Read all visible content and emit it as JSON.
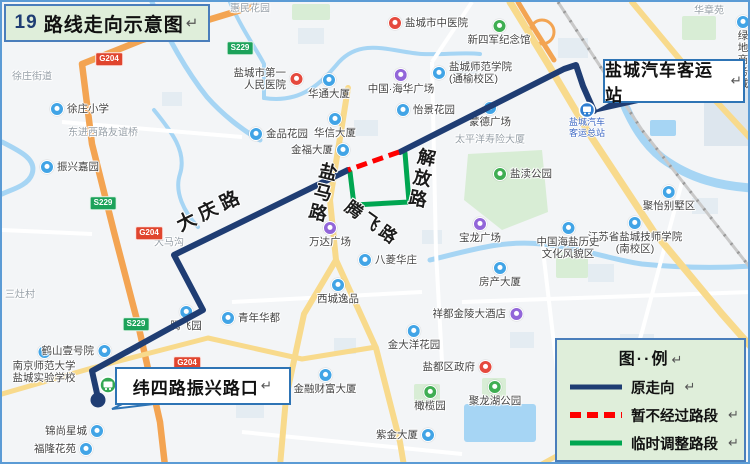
{
  "title": {
    "prefix": "19",
    "text": "路线走向示意图"
  },
  "marks": {
    "return": "↵"
  },
  "callouts": {
    "terminal": "盐城汽车客运站",
    "weisi": "纬四路振兴路口"
  },
  "legend": {
    "title": "图··例",
    "items": [
      {
        "label": "原走向",
        "style": "solid"
      },
      {
        "label": "暂不经过路段",
        "style": "dashed"
      },
      {
        "label": "临时调整路段",
        "style": "solid"
      }
    ]
  },
  "colors": {
    "route_original": "#1f3d73",
    "route_closed": "#fe0000",
    "route_temp": "#00a651",
    "box_bg": "#dfeeda",
    "box_border": "#4a7ebb",
    "callout_border": "#2e74b5",
    "terminal_icon": "#2f7fd2",
    "stop_icon": "#34a853",
    "station_text": "#3a66c4",
    "poi_blue": "#41a4e6",
    "poi_purple": "#9266d9",
    "poi_red": "#e5493d",
    "poi_green": "#3fae52"
  },
  "map": {
    "terminal_station_label": "盐城汽车\n客运总站",
    "road_labels": [
      {
        "t": "大庆路",
        "x": 172,
        "y": 216,
        "r": -26,
        "s": 19,
        "ls": 5,
        "v": false
      },
      {
        "t": "盐马路",
        "x": 318,
        "y": 158,
        "r": 14,
        "s": 18,
        "ls": 3,
        "v": true
      },
      {
        "t": "解放路",
        "x": 416,
        "y": 144,
        "r": 12,
        "s": 18,
        "ls": 3,
        "v": true
      },
      {
        "t": "腾飞路",
        "x": 350,
        "y": 196,
        "r": 36,
        "s": 17,
        "ls": 4,
        "v": false
      }
    ],
    "shields": [
      {
        "t": "S229",
        "c": "green",
        "x": 238,
        "y": 46
      },
      {
        "t": "S229",
        "c": "green",
        "x": 101,
        "y": 201
      },
      {
        "t": "S229",
        "c": "green",
        "x": 134,
        "y": 322
      },
      {
        "t": "G204",
        "c": "red",
        "x": 107,
        "y": 57
      },
      {
        "t": "G204",
        "c": "red",
        "x": 147,
        "y": 231
      },
      {
        "t": "G204",
        "c": "red",
        "x": 185,
        "y": 361
      }
    ],
    "pois": [
      {
        "t": "徐庄街道",
        "x": 10,
        "y": 75,
        "c": "none"
      },
      {
        "t": "惠民花园",
        "x": 228,
        "y": 7,
        "c": "none"
      },
      {
        "t": "华章苑",
        "x": 692,
        "y": 9,
        "c": "none"
      },
      {
        "t": "大马沟",
        "x": 152,
        "y": 241,
        "c": "none"
      },
      {
        "t": "三灶村",
        "x": 3,
        "y": 293,
        "c": "none"
      },
      {
        "t": "东进西路友谊桥",
        "x": 66,
        "y": 131,
        "c": "none"
      },
      {
        "t": "太平洋寿险大厦",
        "x": 453,
        "y": 138,
        "c": "none"
      },
      {
        "t": "盐城市中医院",
        "x": 393,
        "y": 21,
        "c": "red",
        "side": "right"
      },
      {
        "t": "新四军纪念馆",
        "x": 497,
        "y": 24,
        "c": "green",
        "side": "below"
      },
      {
        "t": "绿地商务城",
        "x": 741,
        "y": 20,
        "c": "blue",
        "side": "below"
      },
      {
        "t": "盐城师范学院\n(通榆校区)",
        "x": 437,
        "y": 71,
        "c": "blue",
        "side": "right"
      },
      {
        "t": "盐城市第一\n人民医院",
        "x": 287,
        "y": 77,
        "c": "red",
        "side": "left"
      },
      {
        "t": "中国·海华广场",
        "x": 399,
        "y": 73,
        "c": "purple",
        "side": "below"
      },
      {
        "t": "华通大厦",
        "x": 327,
        "y": 78,
        "c": "blue",
        "side": "below"
      },
      {
        "t": "蒙德广场",
        "x": 488,
        "y": 106,
        "c": "blue",
        "side": "below"
      },
      {
        "t": "怡景花园",
        "x": 401,
        "y": 108,
        "c": "blue",
        "side": "right"
      },
      {
        "t": "华信大厦",
        "x": 333,
        "y": 117,
        "c": "blue",
        "side": "below"
      },
      {
        "t": "金品花园",
        "x": 254,
        "y": 132,
        "c": "blue",
        "side": "right"
      },
      {
        "t": "徐庄小学",
        "x": 55,
        "y": 107,
        "c": "blue",
        "side": "right"
      },
      {
        "t": "振兴嘉园",
        "x": 45,
        "y": 165,
        "c": "blue",
        "side": "right"
      },
      {
        "t": "金福大厦",
        "x": 334,
        "y": 148,
        "c": "blue",
        "side": "left"
      },
      {
        "t": "聚怡别墅区",
        "x": 667,
        "y": 190,
        "c": "blue",
        "side": "below"
      },
      {
        "t": "江苏省盐城技师学院\n(南校区)",
        "x": 633,
        "y": 221,
        "c": "blue",
        "side": "below"
      },
      {
        "t": "盐渎公园",
        "x": 498,
        "y": 172,
        "c": "green",
        "side": "right"
      },
      {
        "t": "宝龙广场",
        "x": 478,
        "y": 222,
        "c": "purple",
        "side": "below"
      },
      {
        "t": "中国海盐历史\n文化风貌区",
        "x": 566,
        "y": 226,
        "c": "blue",
        "side": "below"
      },
      {
        "t": "万达广场",
        "x": 328,
        "y": 226,
        "c": "purple",
        "side": "below"
      },
      {
        "t": "腾飞园",
        "x": 184,
        "y": 310,
        "c": "blue",
        "side": "below"
      },
      {
        "t": "青年华都",
        "x": 226,
        "y": 316,
        "c": "blue",
        "side": "right"
      },
      {
        "t": "八菱华庄",
        "x": 363,
        "y": 258,
        "c": "blue",
        "side": "right"
      },
      {
        "t": "西城逸品",
        "x": 336,
        "y": 283,
        "c": "blue",
        "side": "below"
      },
      {
        "t": "房产大厦",
        "x": 498,
        "y": 266,
        "c": "blue",
        "side": "below"
      },
      {
        "t": "祥都金陵大酒店",
        "x": 507,
        "y": 312,
        "c": "purple",
        "side": "left"
      },
      {
        "t": "金大洋花园",
        "x": 412,
        "y": 329,
        "c": "blue",
        "side": "below"
      },
      {
        "t": "盐都区政府",
        "x": 476,
        "y": 365,
        "c": "red",
        "side": "left"
      },
      {
        "t": "金融财富大厦",
        "x": 323,
        "y": 373,
        "c": "blue",
        "side": "below"
      },
      {
        "t": "紫金大厦",
        "x": 419,
        "y": 433,
        "c": "blue",
        "side": "left"
      },
      {
        "t": "橄榄园",
        "x": 428,
        "y": 390,
        "c": "green",
        "side": "below"
      },
      {
        "t": "聚龙湖公园",
        "x": 493,
        "y": 385,
        "c": "green",
        "side": "below"
      },
      {
        "t": "南京师范大学\n盐城实验学校",
        "x": 42,
        "y": 350,
        "c": "blue",
        "side": "below"
      },
      {
        "t": "鹤山壹号院",
        "x": 95,
        "y": 349,
        "c": "blue",
        "side": "left"
      },
      {
        "t": "锦尚星城",
        "x": 88,
        "y": 429,
        "c": "blue",
        "side": "left"
      },
      {
        "t": "福隆花苑",
        "x": 77,
        "y": 447,
        "c": "blue",
        "side": "left"
      }
    ]
  }
}
